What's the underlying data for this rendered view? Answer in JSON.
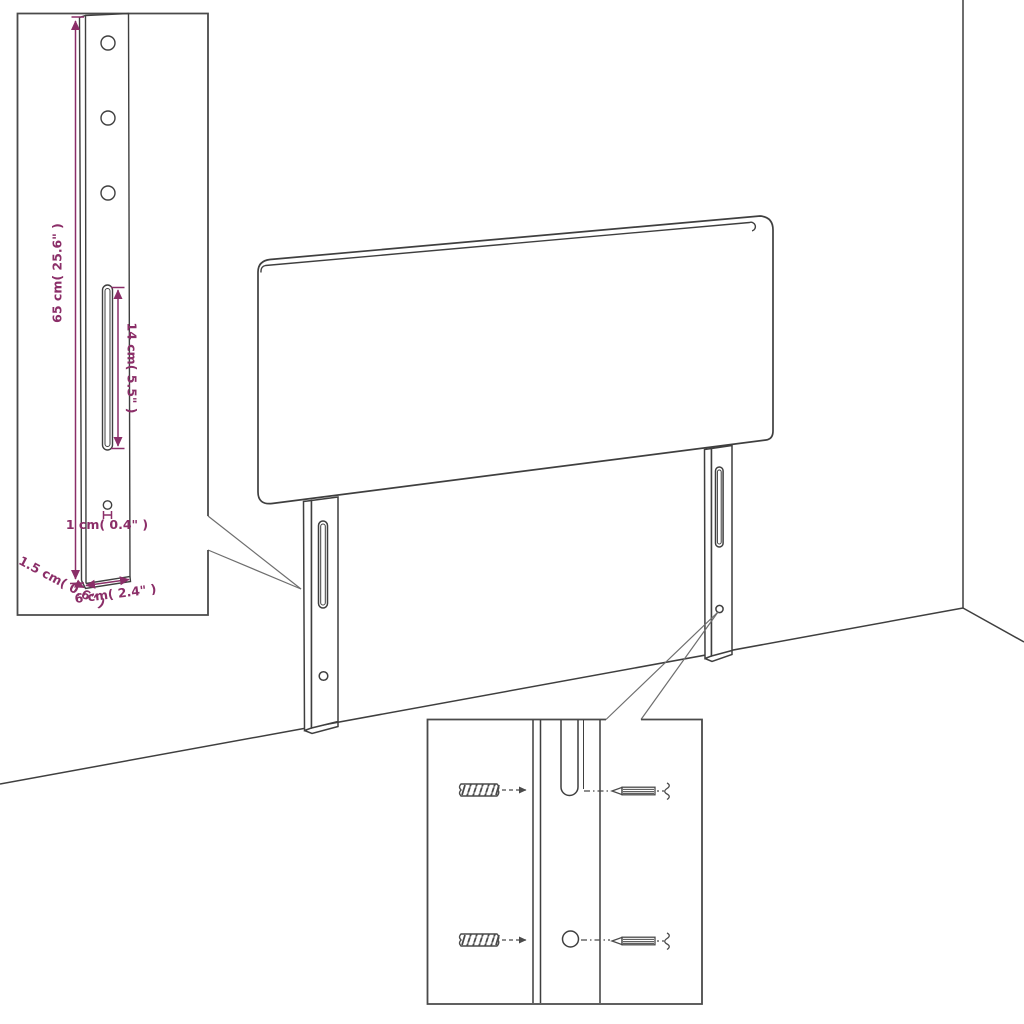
{
  "diagram": {
    "type": "furniture-assembly-dimension-diagram",
    "subject": "upholstered headboard with two mounting legs shown against a room corner, with two zoom-detail callout boxes",
    "colors": {
      "line": "#3f3f3f",
      "dimension": "#8b2e68",
      "background": "#ffffff"
    },
    "parts": [
      "headboard-panel",
      "left-leg",
      "right-leg",
      "leg-slot",
      "leg-mounting-hole",
      "wall-plug",
      "screw",
      "wall-corner",
      "floor-line",
      "leg-detail-inset",
      "mounting-detail-inset"
    ],
    "dimensions": {
      "board_height": {
        "label": "65 cm( 25.6\" )"
      },
      "slot_length": {
        "label": "14 cm( 5.5\" )"
      },
      "hole_diameter": {
        "label": "1 cm( 0.4\" )"
      },
      "leg_width": {
        "label": "6 cm( 2.4\" )"
      },
      "leg_depth": {
        "label": "1.5 cm( 0.6\" )"
      }
    }
  }
}
